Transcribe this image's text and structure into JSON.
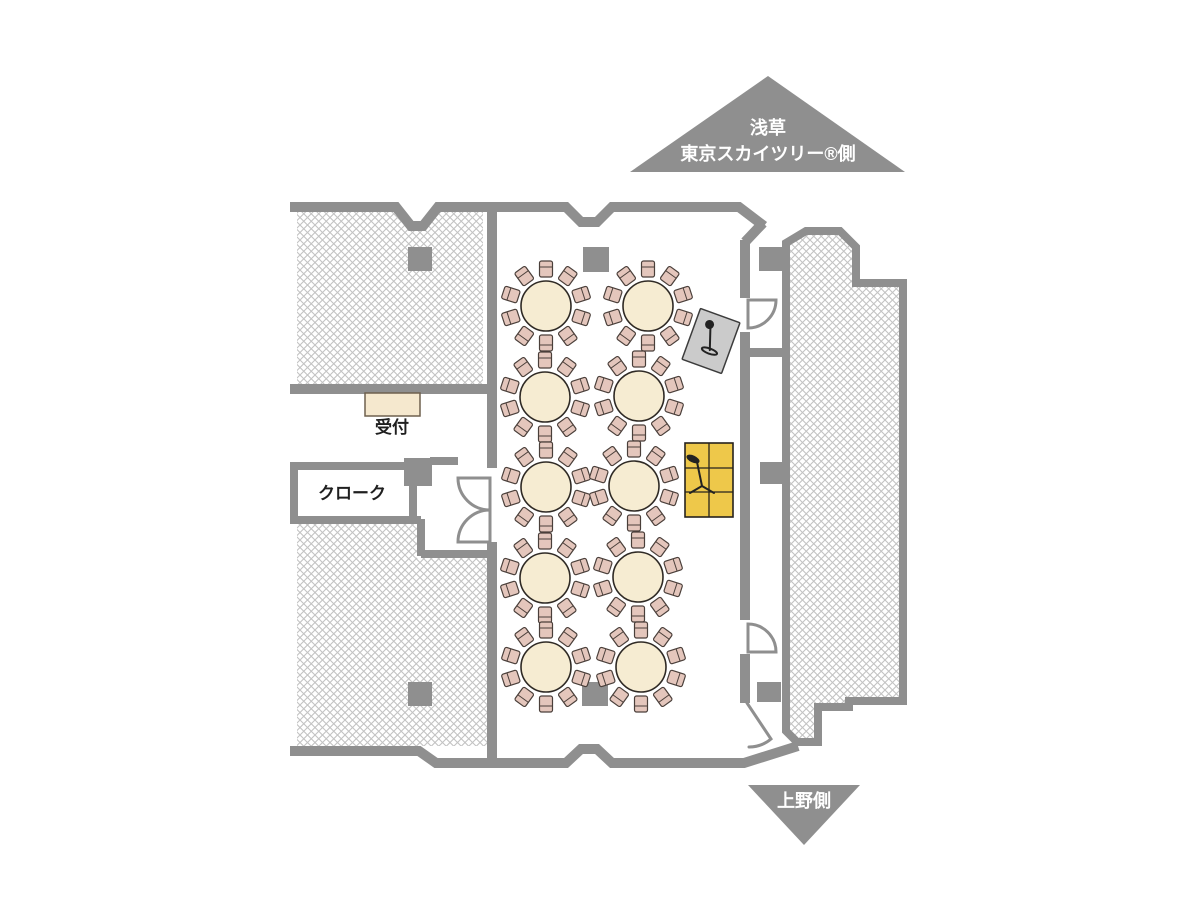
{
  "markers": {
    "top": {
      "line1": "浅草",
      "line2": "東京スカイツリー®側"
    },
    "bottom": {
      "label": "上野側"
    }
  },
  "floorplan": {
    "labels": {
      "reception": "受付",
      "cloakroom": "クローク"
    },
    "icons": {
      "mic_card": "microphone-stand-icon",
      "stage_mic": "microphone-stand-icon"
    },
    "tables": {
      "count": 10,
      "rows": 5,
      "columns": 2,
      "chairs_per_table": 10,
      "table_radius": 25,
      "chair_ring_radius": 37,
      "chair_w": 13,
      "chair_h": 16,
      "positions": [
        {
          "x": 546,
          "y": 306
        },
        {
          "x": 648,
          "y": 306
        },
        {
          "x": 545,
          "y": 397
        },
        {
          "x": 639,
          "y": 396
        },
        {
          "x": 546,
          "y": 487
        },
        {
          "x": 634,
          "y": 486
        },
        {
          "x": 545,
          "y": 578
        },
        {
          "x": 638,
          "y": 577
        },
        {
          "x": 546,
          "y": 667
        },
        {
          "x": 641,
          "y": 667
        }
      ]
    }
  },
  "colors": {
    "wall": "#8f8f8f",
    "hatch_line": "#c3c3c3",
    "table_fill": "#f6ecd2",
    "table_stroke": "#2f2a25",
    "chair_fill": "#e4c6bc",
    "chair_stroke": "#4a3f3a",
    "desk_fill": "#f5e8ce",
    "stage_fill": "#eec84a",
    "mic_card_fill": "#cbcbcb"
  }
}
